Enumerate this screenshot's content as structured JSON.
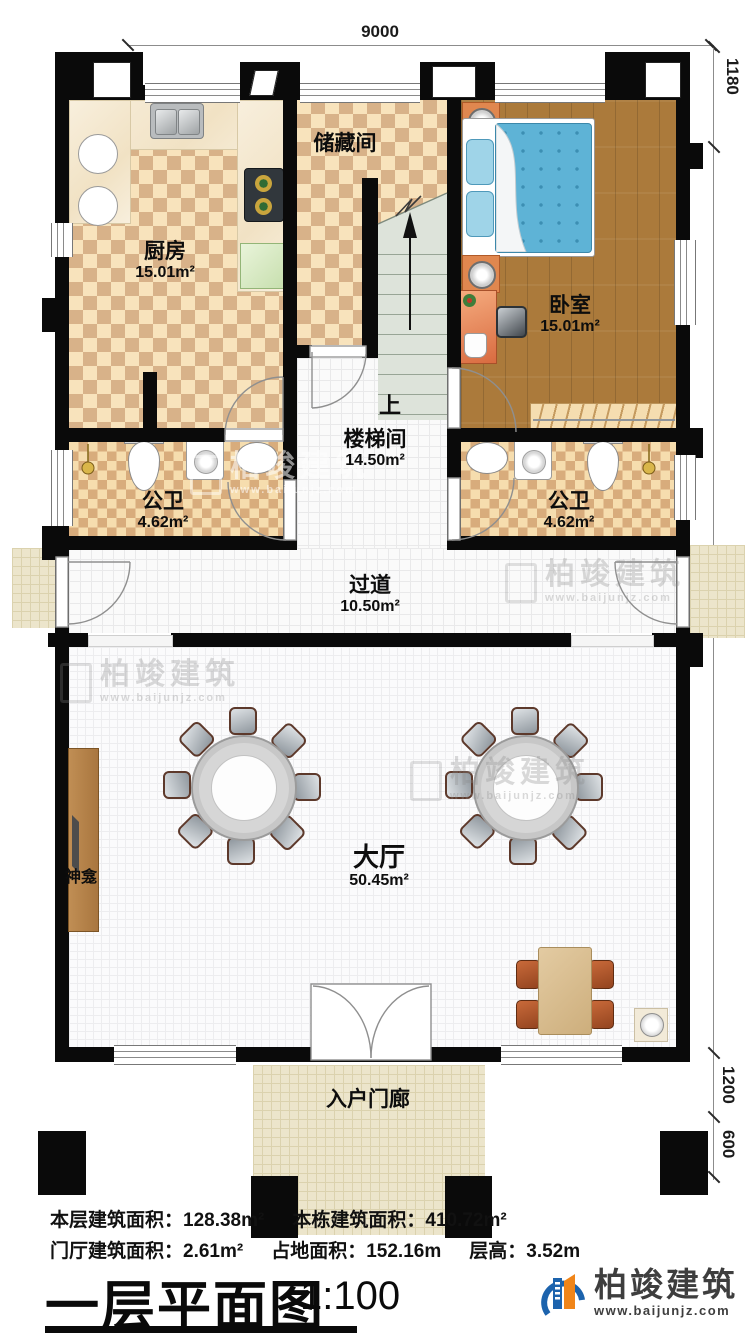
{
  "dims": {
    "top": "9000",
    "right_top": "1180",
    "right_main": "13800",
    "right_porch": "1200",
    "right_steps": "600"
  },
  "rooms": {
    "kitchen": {
      "name": "厨房",
      "area": "15.01m²"
    },
    "storage": {
      "name": "储藏间"
    },
    "bedroom": {
      "name": "卧室",
      "area": "15.01m²"
    },
    "stair": {
      "name": "楼梯间",
      "area": "14.50m²",
      "up": "上"
    },
    "bath_left": {
      "name": "公卫",
      "area": "4.62m²"
    },
    "bath_right": {
      "name": "公卫",
      "area": "4.62m²"
    },
    "corridor": {
      "name": "过道",
      "area": "10.50m²"
    },
    "hall": {
      "name": "大厅",
      "area": "50.45m²"
    },
    "shrine": {
      "name": "神龛"
    },
    "porch": {
      "name": "入户门廊"
    }
  },
  "stats": {
    "floor_area_label": "本层建筑面积：",
    "floor_area_value": "128.38m²",
    "building_area_label": "本栋建筑面积：",
    "building_area_value": "410.72m²",
    "foyer_area_label": "门厅建筑面积：",
    "foyer_area_value": "2.61m²",
    "land_area_label": "占地面积：",
    "land_area_value": "152.16m",
    "height_label": "层高：",
    "height_value": "3.52m"
  },
  "title": {
    "main": "一层平面图",
    "scale": "1:100"
  },
  "brand": {
    "name": "柏竣建筑",
    "url": "www.baijunjz.com"
  },
  "watermark": {
    "name": "柏竣建筑",
    "url": "www.baijunjz.com"
  },
  "colors": {
    "wall": "#0a0a0a",
    "accent_blue": "#1c63ad",
    "accent_orange": "#f08519",
    "bed": "#5eb3d6"
  }
}
